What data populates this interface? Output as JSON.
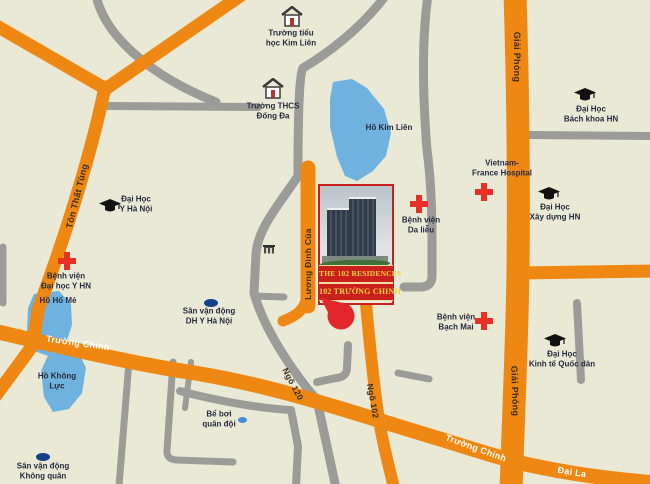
{
  "project": {
    "name_line1": "THE 102 RESIDENCES",
    "name_line2": "102 TRƯỜNG CHINH"
  },
  "road_labels": {
    "truong_chinh_w": "Trường Chinh",
    "truong_chinh_e": "Trường Chinh",
    "dai_la": "Đại La",
    "giai_phong_n": "Giải Phóng",
    "giai_phong_s": "Giải Phóng",
    "ton_that_tung": "Tôn Thất Tùng",
    "luong_dinh_cua": "Lương Đình Của",
    "ngo_102": "Ngõ 102",
    "ngo_120": "Ngõ 120"
  },
  "pois": {
    "school_kim_lien": {
      "l1": "Trường tiểu",
      "l2": "học Kim Liên"
    },
    "school_dong_da": {
      "l1": "Trường THCS",
      "l2": "Đống Đa"
    },
    "uni_y_hanoi": {
      "l1": "Đại Học",
      "l2": "Y Hà Nội"
    },
    "uni_bach_khoa": {
      "l1": "Đại Học",
      "l2": "Bách khoa HN"
    },
    "uni_xay_dung": {
      "l1": "Đại Học",
      "l2": "Xây dựng HN"
    },
    "uni_kinh_te": {
      "l1": "Đại Học",
      "l2": "Kinh tế Quốc dân"
    },
    "hosp_vietnam_france": {
      "l1": "Vietnam-",
      "l2": "France Hospital"
    },
    "hosp_da_lieu": {
      "l1": "Bệnh viện",
      "l2": "Da liễu"
    },
    "hosp_bach_mai": {
      "l1": "Bệnh viện",
      "l2": "Bạch Mai"
    },
    "hosp_dai_hoc_y": {
      "l1": "Bệnh viện",
      "l2": "Đại học Y HN"
    },
    "lake_kim_lien": {
      "l1": "Hồ Kim Liên"
    },
    "lake_ho_me": {
      "l1": "Hồ Hố Mẻ"
    },
    "lake_khong_luc": {
      "l1": "Hồ Không",
      "l2": "Lực"
    },
    "stadium_dh_y": {
      "l1": "Sân vận động",
      "l2": "DH Y Hà Nội"
    },
    "stadium_khong_quan": {
      "l1": "Sân vận động",
      "l2": "Không quân"
    },
    "pool_quan_doi": {
      "l1": "Bể bơi",
      "l2": "quân đội"
    }
  },
  "colors": {
    "background": "#e9e9d6",
    "road_main_orange": "#ef8812",
    "road_secondary_gray": "#9b9b98",
    "water_blue": "#6fb2e0",
    "card_band_red": "#c9201d",
    "card_text_yellow": "#f6d33c",
    "hospital_cross_red": "#e73127",
    "marker_red": "#e2262b",
    "label_navy": "#252b3c"
  }
}
